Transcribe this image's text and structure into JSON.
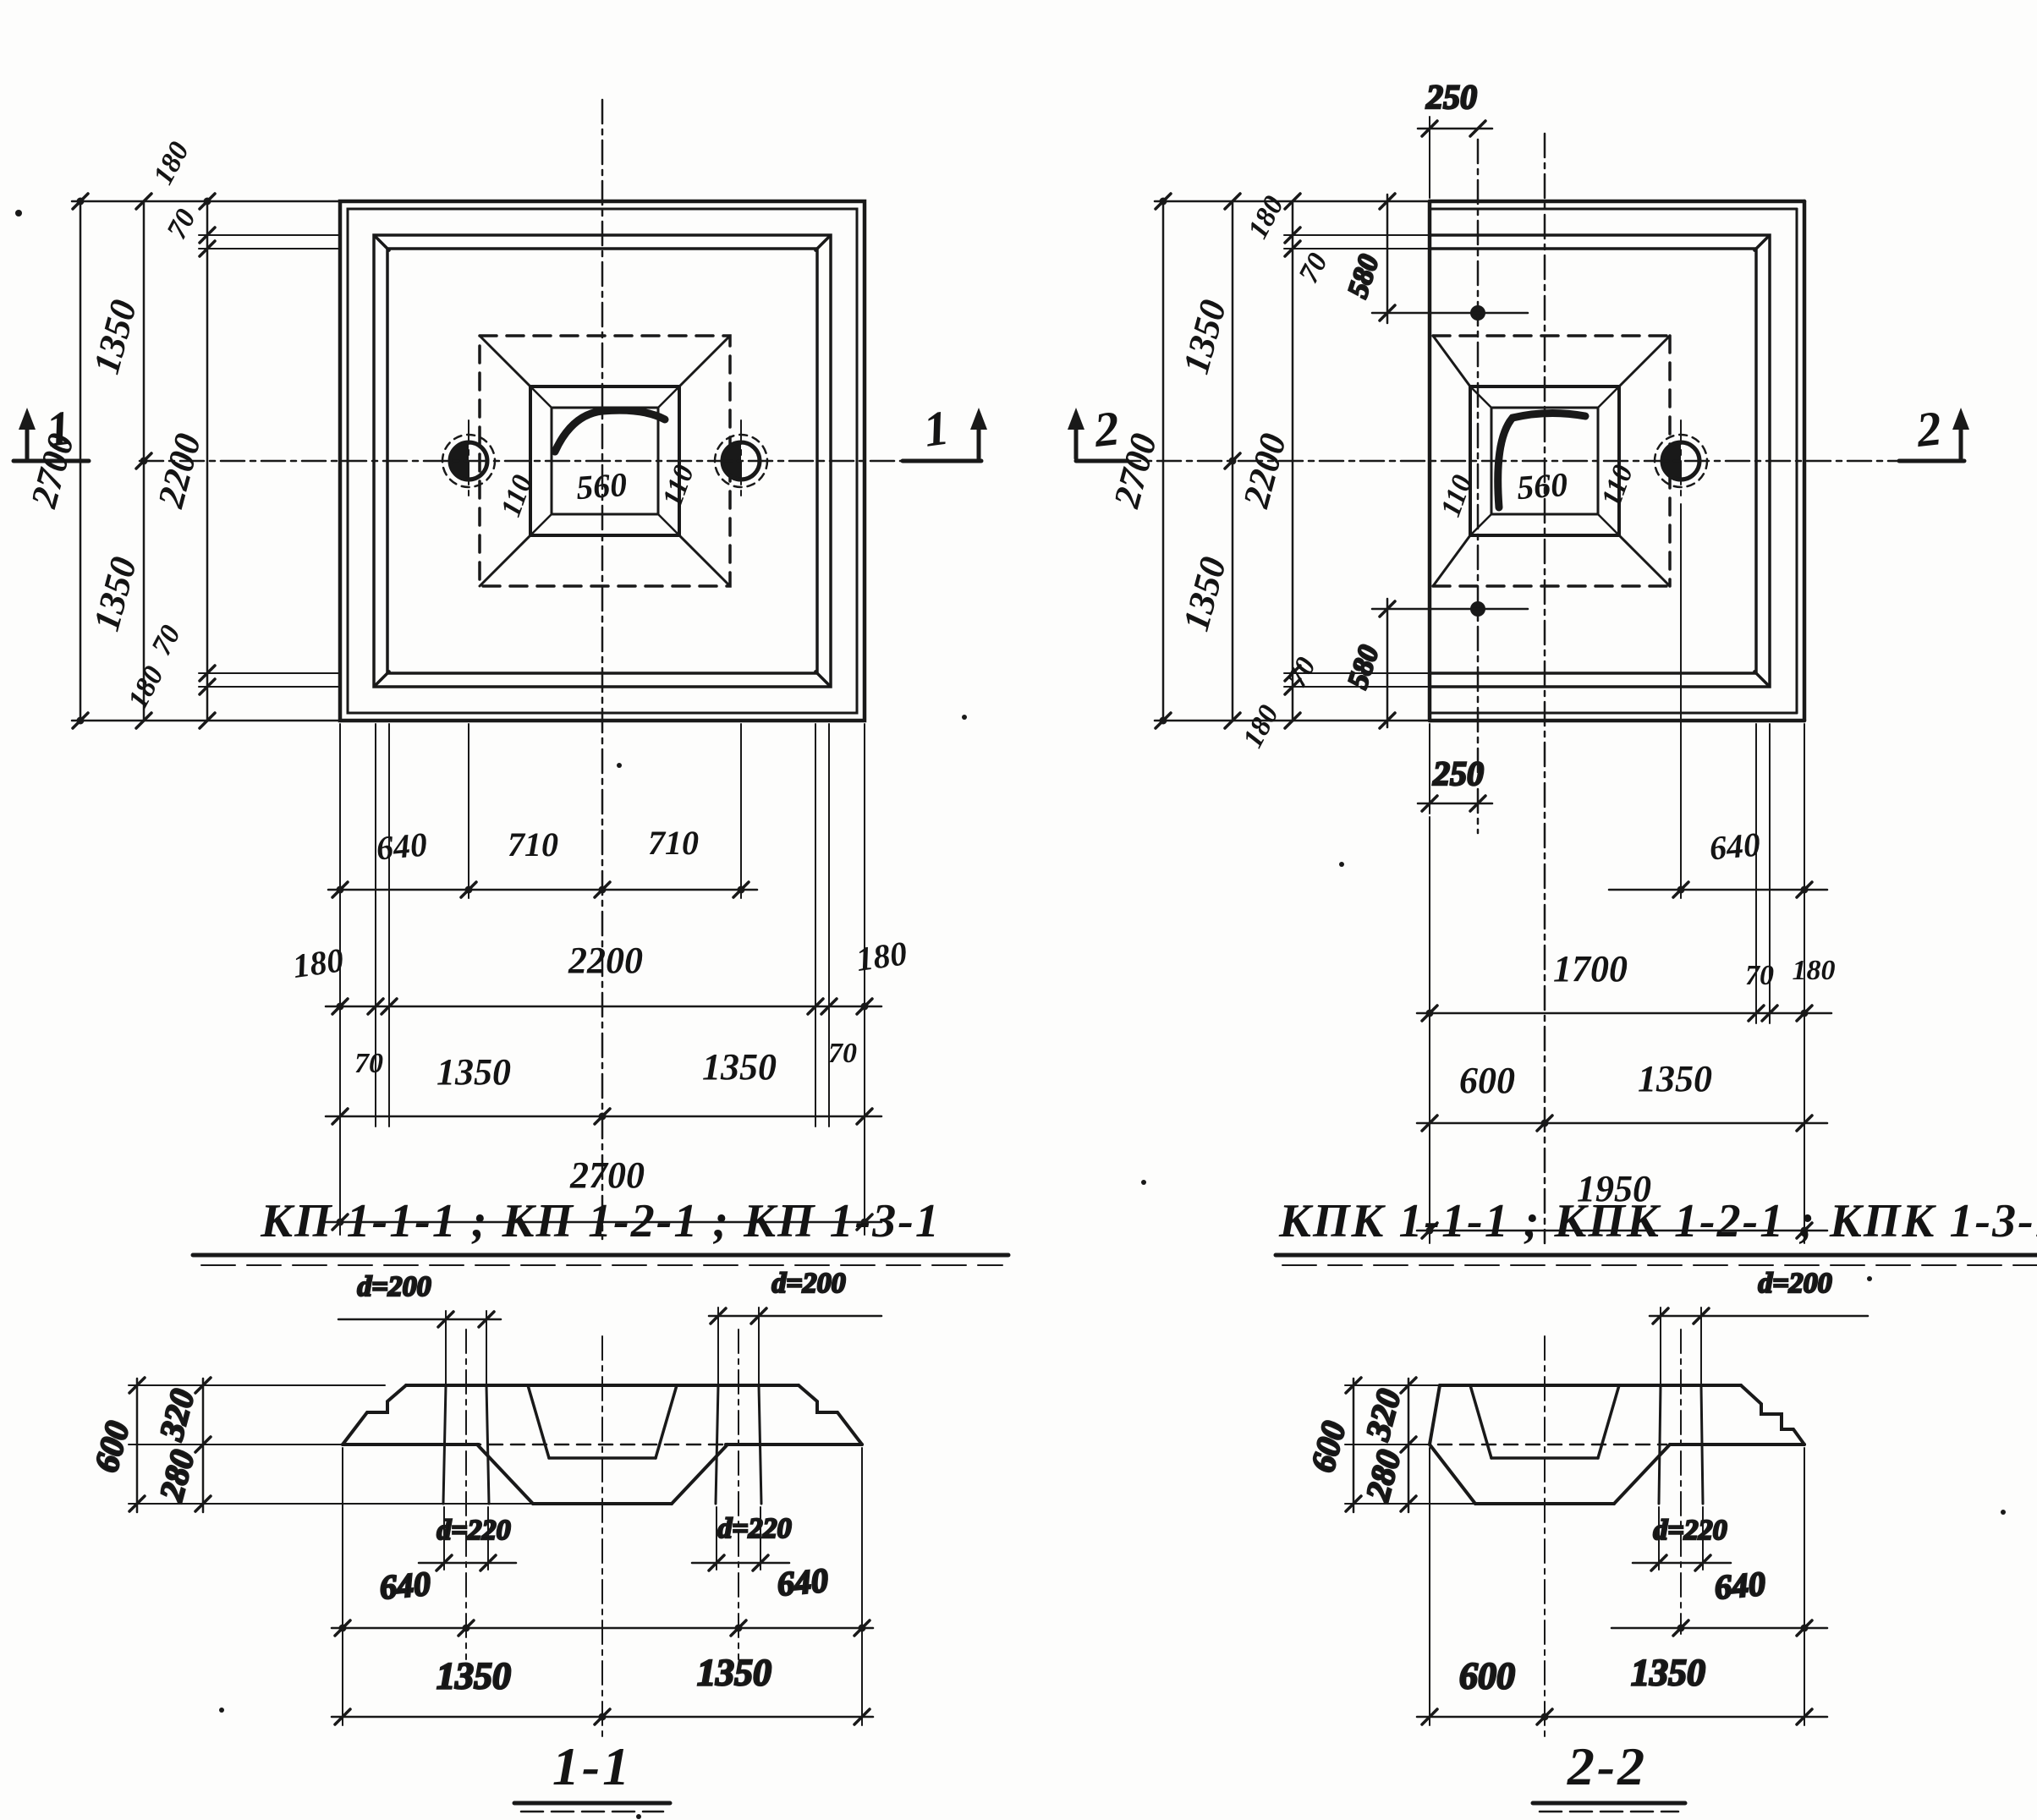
{
  "plan_kp": {
    "title": "КП 1-1-1 ; КП 1-2-1 ; КП 1-3-1",
    "mark": "1",
    "left": {
      "total": "2700",
      "top_half": "1350",
      "bottom_half": "1350",
      "inner": "2200",
      "edge_top": "180",
      "step_top": "70",
      "step_bottom": "70",
      "edge_bottom": "180"
    },
    "socket": {
      "left": "110",
      "size": "560",
      "right": "110"
    },
    "bottom": {
      "edge_to_hole": "640",
      "hole_to_axis": "710",
      "axis_to_hole": "710",
      "edge_left": "180",
      "inner": "2200",
      "edge_right": "180",
      "step_left": "70",
      "step_right": "70",
      "half_left": "1350",
      "half_right": "1350",
      "total": "2700"
    }
  },
  "plan_kpk": {
    "title": "КПК 1-1-1 ; КПК 1-2-1 ; КПК 1-3-1",
    "mark": "2",
    "hole_top_offset": "250",
    "hole_bottom_offset": "250",
    "left": {
      "total": "2700",
      "top_half": "1350",
      "bottom_half": "1350",
      "inner": "2200"
    },
    "diag_top": {
      "edge": "180",
      "step": "70",
      "hole": "580"
    },
    "diag_bottom": {
      "step": "70",
      "edge": "180",
      "hole": "580"
    },
    "socket": {
      "left": "110",
      "size": "560",
      "right": "110"
    },
    "bottom": {
      "hole_to_edge": "640",
      "inner": "1700",
      "step": "70",
      "edge": "180",
      "axis_left": "600",
      "axis_right": "1350",
      "total": "1950"
    }
  },
  "section_11": {
    "title": "1-1",
    "top_hole_left": "d=200",
    "top_hole_right": "d=200",
    "bottom_hole_left": "d=220",
    "bottom_hole_right": "d=220",
    "height": "600",
    "upper": "320",
    "lower": "280",
    "edge_left": "640",
    "edge_right": "640",
    "half_left": "1350",
    "half_right": "1350"
  },
  "section_22": {
    "title": "2-2",
    "top_hole": "d=200",
    "bottom_hole": "d=220",
    "height": "600",
    "upper": "320",
    "lower": "280",
    "hole_to_edge": "640",
    "axis_left": "600",
    "axis_right": "1350"
  }
}
